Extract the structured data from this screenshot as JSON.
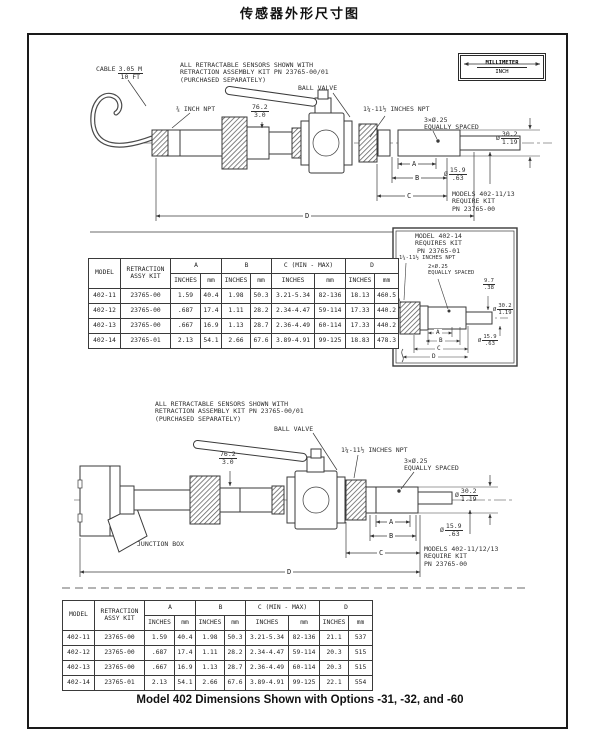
{
  "page": {
    "title": "传感器外形尺寸图",
    "caption": "Model 402 Dimensions Shown with Options -31, -32, and -60"
  },
  "legend": {
    "top": "MILLIMETER",
    "bottom": "INCH"
  },
  "diagram1": {
    "note": "ALL RETRACTABLE SENSORS SHOWN WITH\nRETRACTION ASSEMBLY KIT PN 23765-00/01\n(PURCHASED SEPARATELY)",
    "cable_label": "CABLE",
    "cable_len": {
      "top": "3.05 M",
      "bottom": "10 FT"
    },
    "npt_small": "¾ INCH NPT",
    "ball_valve": "BALL VALVE",
    "dim_76": {
      "top": "76.2",
      "bottom": "3.0"
    },
    "npt_large": "1¼-11½ INCHES NPT",
    "holes": "3×Ø.25\nEQUALLY SPACED",
    "dia_large": {
      "sym": "Ø",
      "top": "30.2",
      "bottom": "1.19"
    },
    "dia_small": {
      "sym": "Ø",
      "top": "15.9",
      "bottom": ".63"
    },
    "dim_a": "A",
    "dim_b": "B",
    "dim_c": "C",
    "dim_d": "D",
    "models_note": "MODELS 402-11/13\nREQUIRE KIT\nPN 23765-00"
  },
  "inset": {
    "title": "MODEL 402-14\nREQUIRES KIT\nPN 23765-01",
    "npt": "1¼-11½ INCHES NPT",
    "holes": "2×Ø.25\nEQUALLY SPACED",
    "dim_97": {
      "top": "9.7",
      "bottom": ".38"
    },
    "dia_large": {
      "sym": "Ø",
      "top": "30.2",
      "bottom": "1.19"
    },
    "dia_small": {
      "sym": "Ø",
      "top": "15.9",
      "bottom": ".63"
    },
    "dim_a": "A",
    "dim_b": "B",
    "dim_c": "C",
    "dim_d": "D"
  },
  "diagram2": {
    "note": "ALL RETRACTABLE SENSORS SHOWN WITH\nRETRACTION ASSEMBLY KIT PN 23765-00/01\n(PURCHASED SEPARATELY)",
    "ball_valve": "BALL VALVE",
    "junction_box": "JUNCTION BOX",
    "dim_76": {
      "top": "76.2",
      "bottom": "3.0"
    },
    "npt_large": "1¼-11½ INCHES NPT",
    "holes": "3×Ø.25\nEQUALLY SPACED",
    "dia_large": {
      "sym": "Ø",
      "top": "30.2",
      "bottom": "1.19"
    },
    "dia_small": {
      "sym": "Ø",
      "top": "15.9",
      "bottom": ".63"
    },
    "dim_a": "A",
    "dim_b": "B",
    "dim_c": "C",
    "dim_d": "D",
    "models_note": "MODELS 402-11/12/13\nREQUIRE KIT\nPN 23765-00"
  },
  "table_headers": {
    "model": "MODEL",
    "retraction": "RETRACTION\nASSY KIT",
    "a": "A",
    "b": "B",
    "c": "C (MIN - MAX)",
    "d": "D",
    "inches": "INCHES",
    "mm": "mm"
  },
  "table1": {
    "rows": [
      [
        "402-11",
        "23765-00",
        "1.59",
        "40.4",
        "1.98",
        "50.3",
        "3.21-5.34",
        "82-136",
        "18.13",
        "460.5"
      ],
      [
        "402-12",
        "23765-00",
        ".687",
        "17.4",
        "1.11",
        "28.2",
        "2.34-4.47",
        "59-114",
        "17.33",
        "440.2"
      ],
      [
        "402-13",
        "23765-00",
        ".667",
        "16.9",
        "1.13",
        "28.7",
        "2.36-4.49",
        "60-114",
        "17.33",
        "440.2"
      ],
      [
        "402-14",
        "23765-01",
        "2.13",
        "54.1",
        "2.66",
        "67.6",
        "3.89-4.91",
        "99-125",
        "18.83",
        "478.3"
      ]
    ]
  },
  "table2": {
    "rows": [
      [
        "402-11",
        "23765-00",
        "1.59",
        "40.4",
        "1.98",
        "50.3",
        "3.21-5.34",
        "82-136",
        "21.1",
        "537"
      ],
      [
        "402-12",
        "23765-00",
        ".687",
        "17.4",
        "1.11",
        "28.2",
        "2.34-4.47",
        "59-114",
        "20.3",
        "515"
      ],
      [
        "402-13",
        "23765-00",
        ".667",
        "16.9",
        "1.13",
        "28.7",
        "2.36-4.49",
        "60-114",
        "20.3",
        "515"
      ],
      [
        "402-14",
        "23765-01",
        "2.13",
        "54.1",
        "2.66",
        "67.6",
        "3.89-4.91",
        "99-125",
        "22.1",
        "554"
      ]
    ]
  }
}
